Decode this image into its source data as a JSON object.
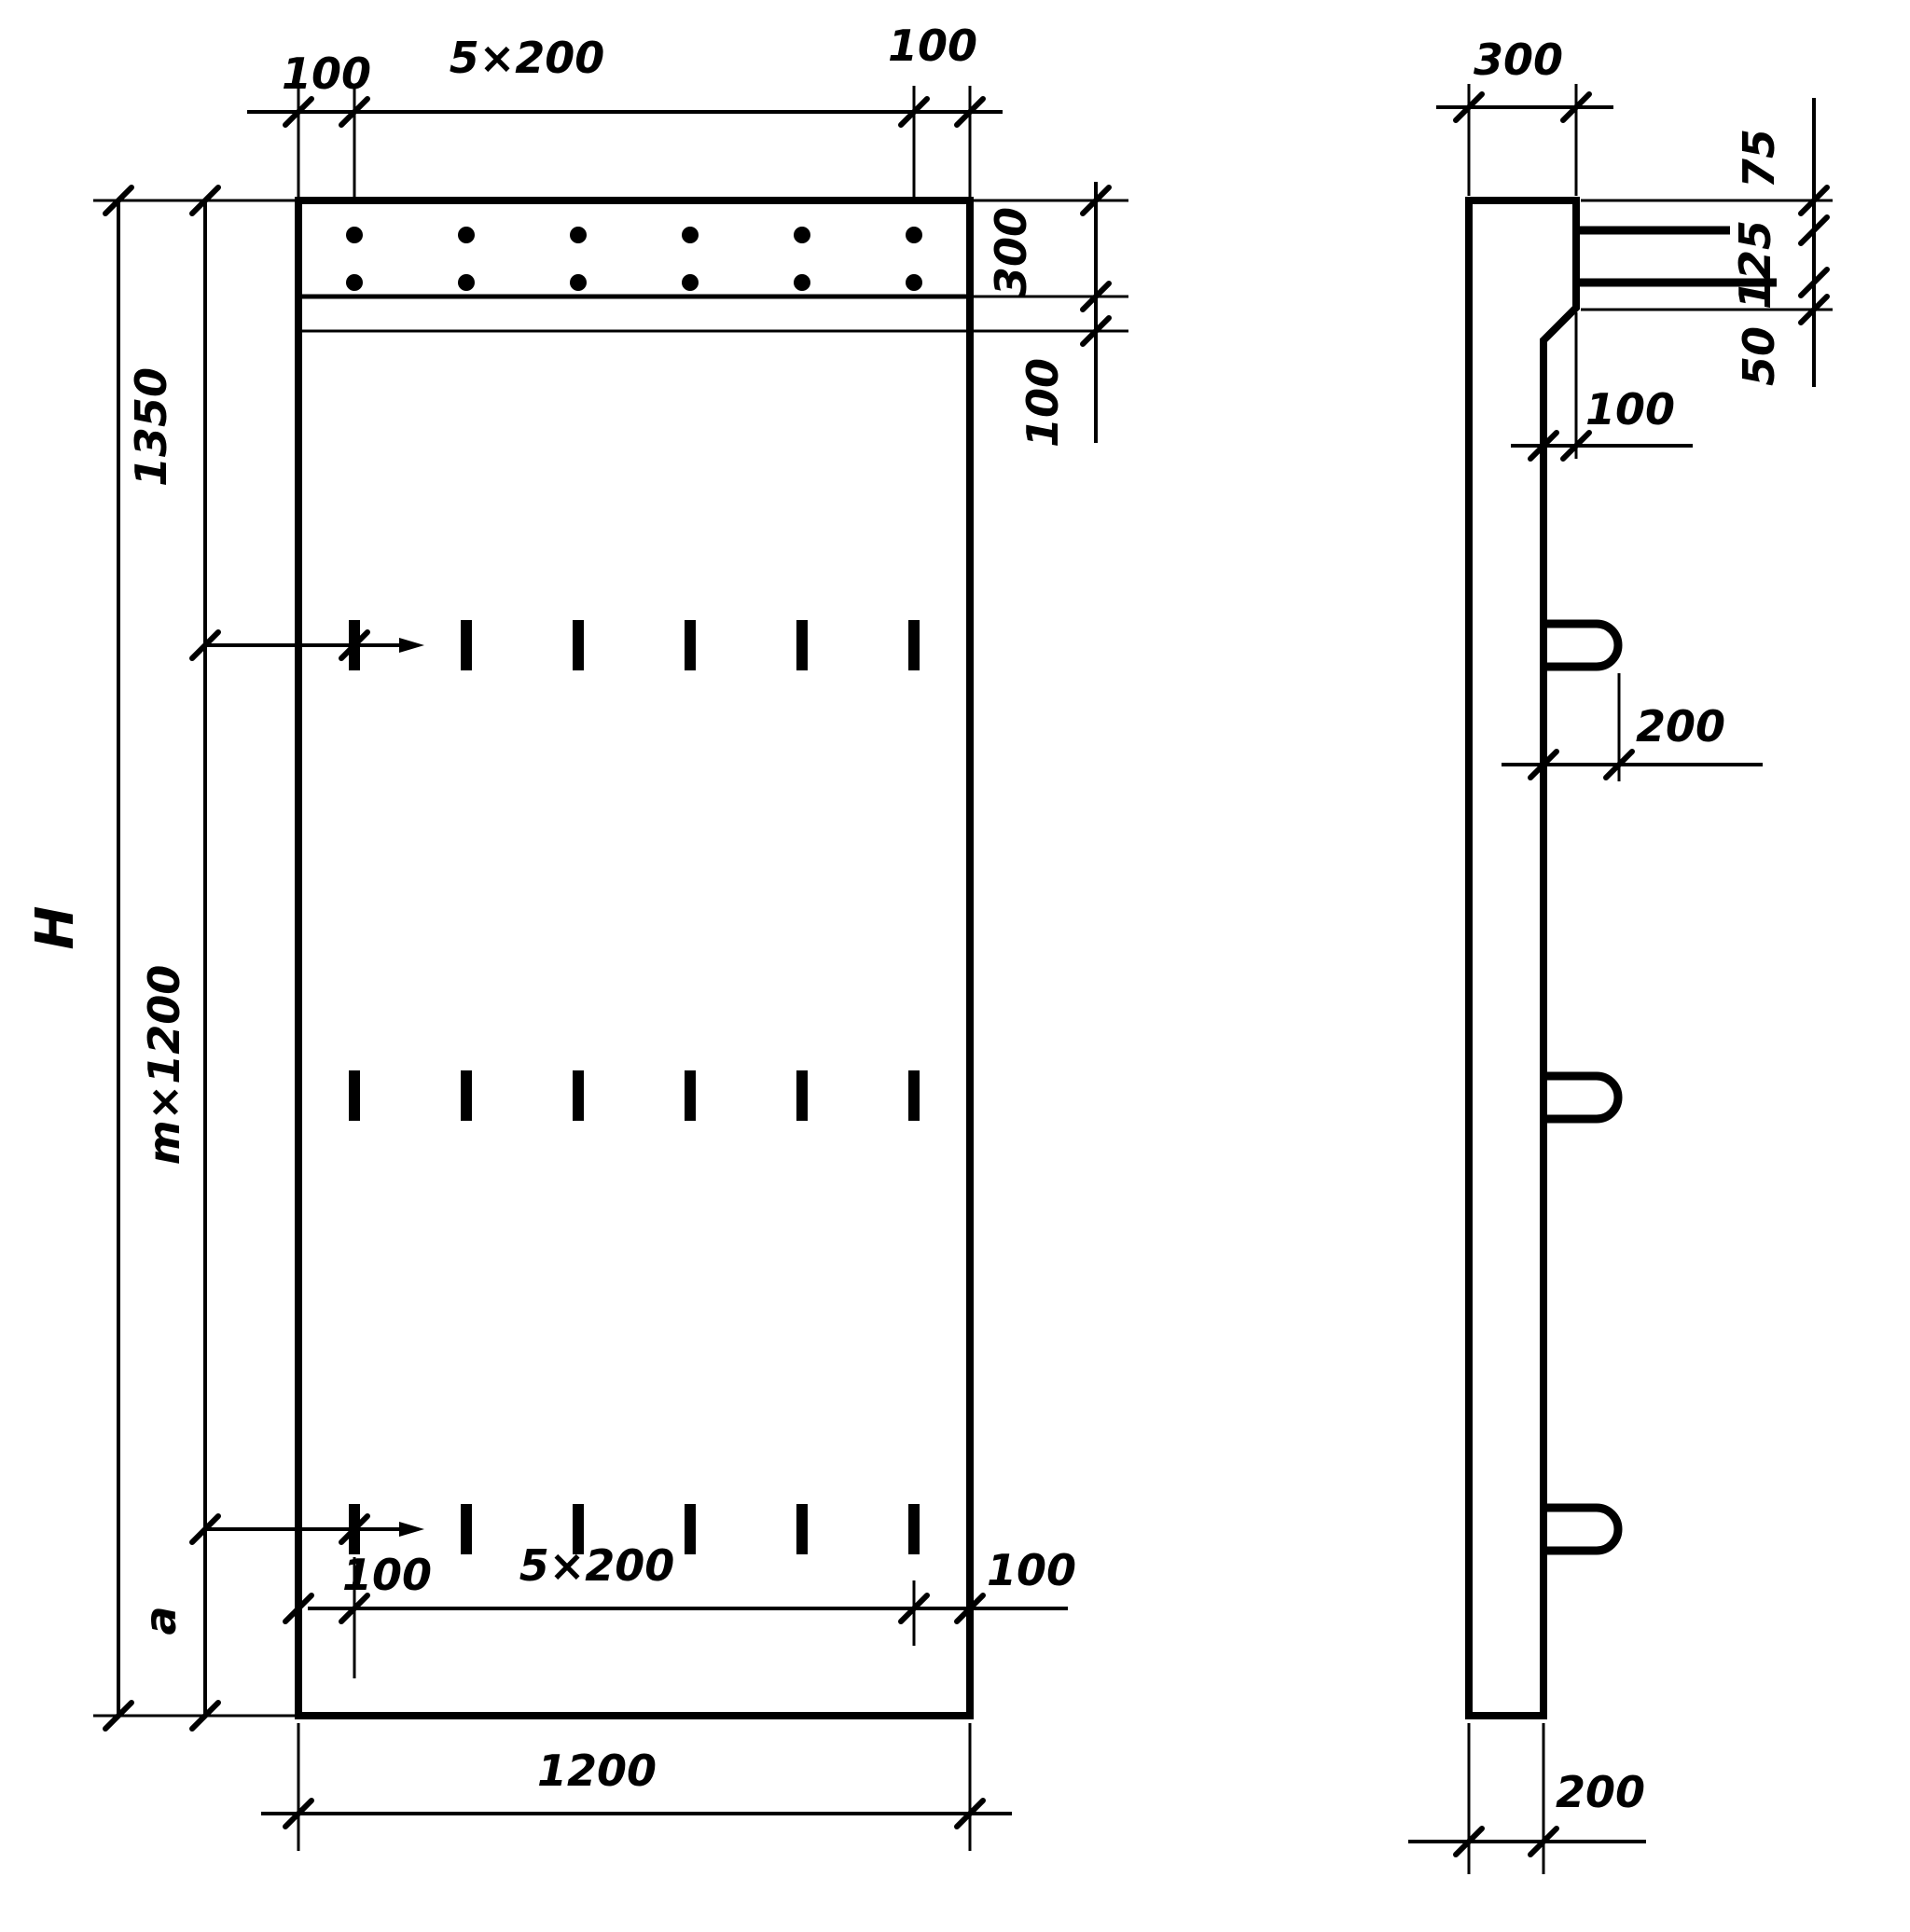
{
  "drawing": {
    "front_view": {
      "top_chain": {
        "left": "100",
        "middle": "5×200",
        "right": "100"
      },
      "right_chain": {
        "band": "300",
        "strip": "100"
      },
      "left_outer": {
        "overall_height": "H"
      },
      "left_chain": {
        "top": "1350",
        "middle": "m×1200",
        "bottom": "a"
      },
      "bottom_chain": {
        "left": "100",
        "middle": "5×200",
        "right": "100"
      },
      "overall_width": "1200"
    },
    "side_view": {
      "top_width": "300",
      "right_chain": {
        "top": "75",
        "middle": "125",
        "bottom": "50"
      },
      "ledge_offset": "100",
      "loop_projection": "200",
      "bottom_width": "200"
    },
    "colors": {
      "ink": "#000000",
      "paper": "#ffffff"
    }
  }
}
